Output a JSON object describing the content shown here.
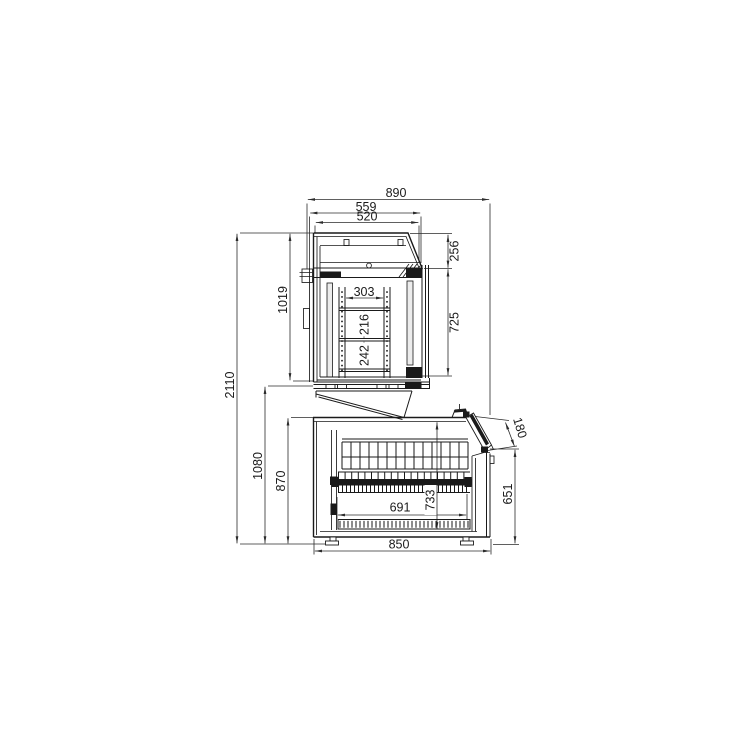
{
  "page": {
    "background_color": "#ffffff",
    "drawing_line_color": "#1a1a1a"
  },
  "drawing": {
    "description": "Side-section technical drawing of a two-deck refrigerated display unit: upper shelved cabinet over a lower well cabinet with slanted front flap",
    "dimensions": {
      "overall_depth": "890",
      "upper_top_depth": "559",
      "upper_inner_depth": "520",
      "upper_canopy_height": "256",
      "upper_unit_height": "1019",
      "shelf_clear_depth": "303",
      "shelf_gap_upper": "216",
      "shelf_gap_lower": "242",
      "upper_door_height": "725",
      "overall_height": "2110",
      "lower_section_height": "1080",
      "lower_body_height": "870",
      "front_flap_depth": "180",
      "front_height": "651",
      "well_height": "733",
      "well_depth": "691",
      "base_depth": "850"
    }
  }
}
